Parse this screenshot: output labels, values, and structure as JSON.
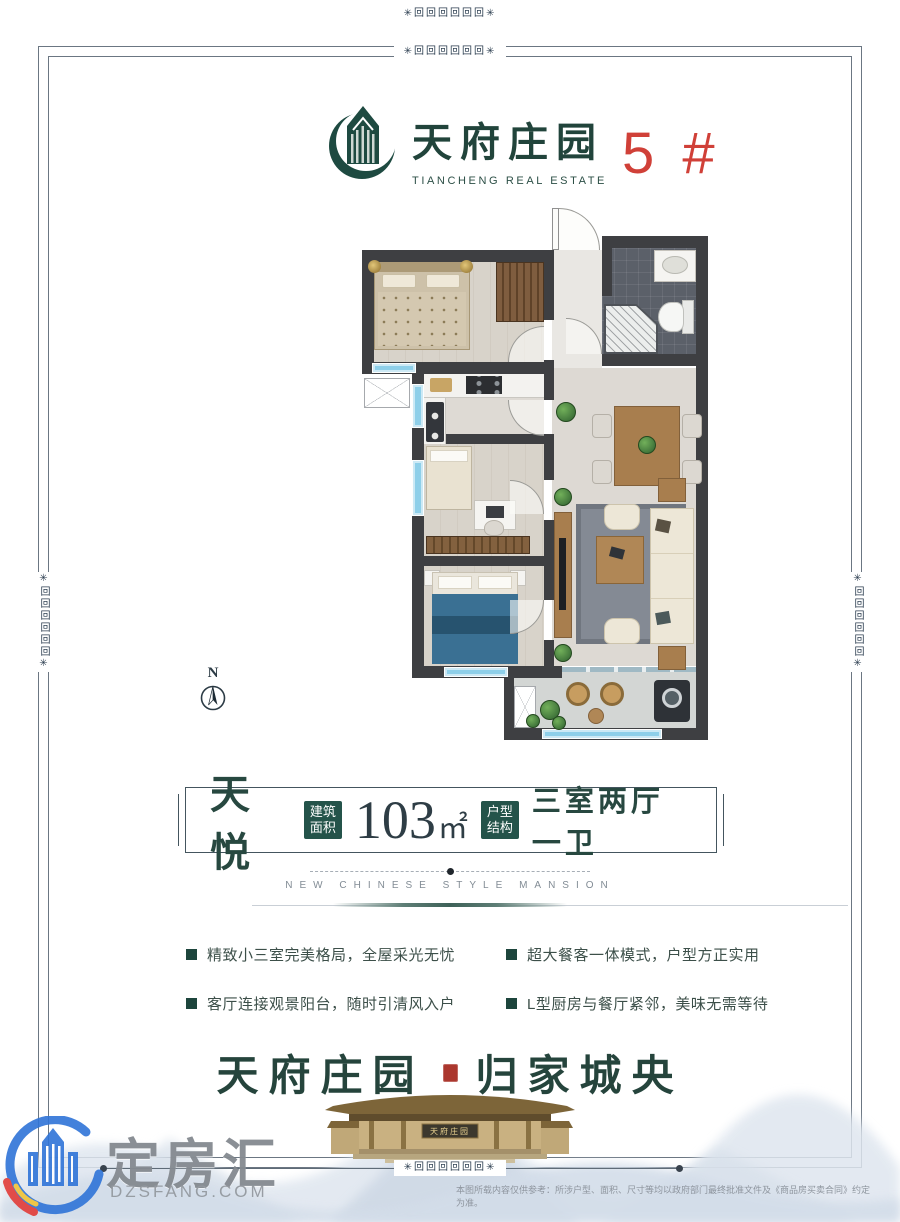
{
  "header": {
    "brand_cn": "天府庄园",
    "brand_en": "TIANCHENG REAL ESTATE",
    "unit_number": "5 #"
  },
  "compass": {
    "north_label": "N"
  },
  "spec": {
    "unit_name": "天悦",
    "area_badge_top": "建筑",
    "area_badge_bottom": "面积",
    "area_value": "103",
    "area_unit": "㎡",
    "layout_badge_top": "户型",
    "layout_badge_bottom": "结构",
    "layout_value": "三室两厅一卫"
  },
  "divider": {
    "caption_en": "NEW CHINESE STYLE MANSION"
  },
  "features": {
    "left": [
      "精致小三室完美格局，全屋采光无忧",
      "客厅连接观景阳台，随时引清风入户"
    ],
    "right": [
      "超大餐客一体模式，户型方正实用",
      "L型厨房与餐厅紧邻，美味无需等待"
    ]
  },
  "footer": {
    "slogan_left": "天府庄园",
    "slogan_right": "归家城央",
    "gate_plaque": "天府庄园",
    "disclaimer": "本图所载内容仅供参考：所涉户型、面积、尺寸等均以政府部门最终批准文件及《商品房买卖合同》约定为准。"
  },
  "watermark": {
    "brand": "定房汇",
    "site": "DZSFANG.COM"
  },
  "ornaments": {
    "meander": "✳回回回回回回✳"
  },
  "colors": {
    "brand_green": "#1e4a41",
    "accent_red": "#d04038",
    "wall_dark": "#3e3f42",
    "window_blue": "#8ecfe9",
    "badge_green": "#24534a"
  }
}
